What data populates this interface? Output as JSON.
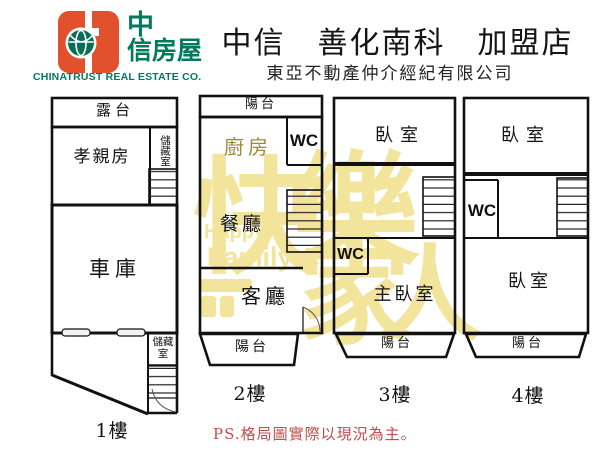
{
  "header": {
    "brand_line1": "中",
    "brand_line2": "信房屋",
    "brand_en": "CHINATRUST REAL ESTATE CO.",
    "title": "中信　善化南科　加盟店",
    "subtitle": "東亞不動產仲介經紀有限公司",
    "brand_orange": "#e2512d",
    "brand_green": "#00795c"
  },
  "plan": {
    "f1": {
      "floor_label": "1樓",
      "terrace": "露台",
      "parents_room": "孝親房",
      "storage_top": "儲藏室",
      "garage": "車庫",
      "storage_bottom": "儲藏室"
    },
    "f2": {
      "floor_label": "2樓",
      "balcony_top": "陽台",
      "kitchen": "廚房",
      "wc": "WC",
      "dining": "餐廳",
      "living": "客廳",
      "balcony_bottom": "陽台"
    },
    "f3": {
      "floor_label": "3樓",
      "bedroom": "臥室",
      "wc": "WC",
      "master_bedroom": "主臥室",
      "balcony": "陽台"
    },
    "f4": {
      "floor_label": "4樓",
      "bedroom_top": "臥室",
      "wc": "WC",
      "bedroom_bottom": "臥室",
      "balcony": "陽台"
    }
  },
  "watermark": {
    "char_kuai": "快",
    "char_le": "樂",
    "word_happy": "Happy",
    "word_family": "Family",
    "char_jia": "家",
    "char_ren": "人",
    "color": "#f2e49a"
  },
  "footnote": "PS.格局圖實際以現況為主。"
}
